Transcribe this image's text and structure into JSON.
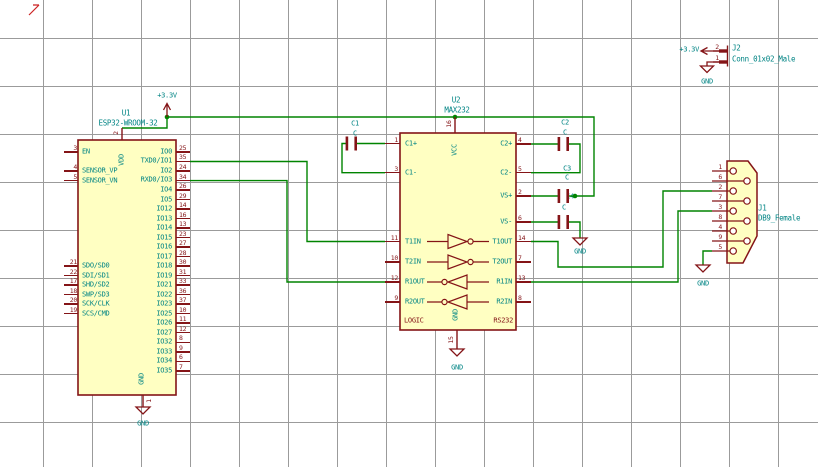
{
  "schematic": {
    "power": {
      "v33": "+3.3V",
      "gnd": "GND"
    },
    "u1": {
      "ref": "U1",
      "value": "ESP32-WROOM-32",
      "top_pin": {
        "num": "2",
        "name": "VDD"
      },
      "bottom_pin": {
        "num": "1",
        "name": "GND"
      },
      "pins_left_top": [
        {
          "num": "3",
          "name": "EN"
        },
        {
          "num": "4",
          "name": "SENSOR_VP"
        },
        {
          "num": "5",
          "name": "SENSOR_VN"
        }
      ],
      "pins_left_bottom": [
        {
          "num": "21",
          "name": "SDO/SD0"
        },
        {
          "num": "22",
          "name": "SDI/SD1"
        },
        {
          "num": "17",
          "name": "SHD/SD2"
        },
        {
          "num": "18",
          "name": "SWP/SD3"
        },
        {
          "num": "20",
          "name": "SCK/CLK"
        },
        {
          "num": "19",
          "name": "SCS/CMD"
        }
      ],
      "pins_right": [
        {
          "num": "25",
          "name": "IO0"
        },
        {
          "num": "35",
          "name": "TXD0/IO1"
        },
        {
          "num": "24",
          "name": "IO2"
        },
        {
          "num": "34",
          "name": "RXD0/IO3"
        },
        {
          "num": "26",
          "name": "IO4"
        },
        {
          "num": "29",
          "name": "IO5"
        },
        {
          "num": "14",
          "name": "IO12"
        },
        {
          "num": "16",
          "name": "IO13"
        },
        {
          "num": "13",
          "name": "IO14"
        },
        {
          "num": "23",
          "name": "IO15"
        },
        {
          "num": "27",
          "name": "IO16"
        },
        {
          "num": "28",
          "name": "IO17"
        },
        {
          "num": "30",
          "name": "IO18"
        },
        {
          "num": "31",
          "name": "IO19"
        },
        {
          "num": "33",
          "name": "IO21"
        },
        {
          "num": "36",
          "name": "IO22"
        },
        {
          "num": "37",
          "name": "IO23"
        },
        {
          "num": "10",
          "name": "IO25"
        },
        {
          "num": "11",
          "name": "IO26"
        },
        {
          "num": "12",
          "name": "IO27"
        },
        {
          "num": "8",
          "name": "IO32"
        },
        {
          "num": "9",
          "name": "IO33"
        },
        {
          "num": "6",
          "name": "IO34"
        },
        {
          "num": "7",
          "name": "IO35"
        }
      ]
    },
    "u2": {
      "ref": "U2",
      "value": "MAX232",
      "top_pin": {
        "num": "16",
        "name": "VCC"
      },
      "bottom_pin": {
        "num": "15",
        "name": "GND"
      },
      "sub_label_left": "LOGIC",
      "sub_label_right": "RS232",
      "pins_left": [
        {
          "num": "1",
          "name": "C1+"
        },
        {
          "num": "3",
          "name": "C1-"
        },
        {
          "num": "11",
          "name": "T1IN"
        },
        {
          "num": "10",
          "name": "T2IN"
        },
        {
          "num": "12",
          "name": "R1OUT"
        },
        {
          "num": "9",
          "name": "R2OUT"
        }
      ],
      "pins_right": [
        {
          "num": "4",
          "name": "C2+"
        },
        {
          "num": "5",
          "name": "C2-"
        },
        {
          "num": "2",
          "name": "VS+"
        },
        {
          "num": "6",
          "name": "VS-"
        },
        {
          "num": "14",
          "name": "T1OUT"
        },
        {
          "num": "7",
          "name": "T2OUT"
        },
        {
          "num": "13",
          "name": "R1IN"
        },
        {
          "num": "8",
          "name": "R2IN"
        }
      ]
    },
    "j1": {
      "ref": "J1",
      "value": "DB9_Female",
      "pin_numbers": [
        "1",
        "6",
        "2",
        "7",
        "3",
        "8",
        "4",
        "9",
        "5"
      ]
    },
    "j2": {
      "ref": "J2",
      "value": "Conn_01x02_Male",
      "pin_top": "2",
      "pin_bottom": "1"
    },
    "capacitors": [
      {
        "ref": "C1",
        "value": "C"
      },
      {
        "ref": "C2",
        "value": "C"
      },
      {
        "ref": "C3",
        "value": "C"
      },
      {
        "ref": "C4",
        "value": "C"
      }
    ]
  }
}
